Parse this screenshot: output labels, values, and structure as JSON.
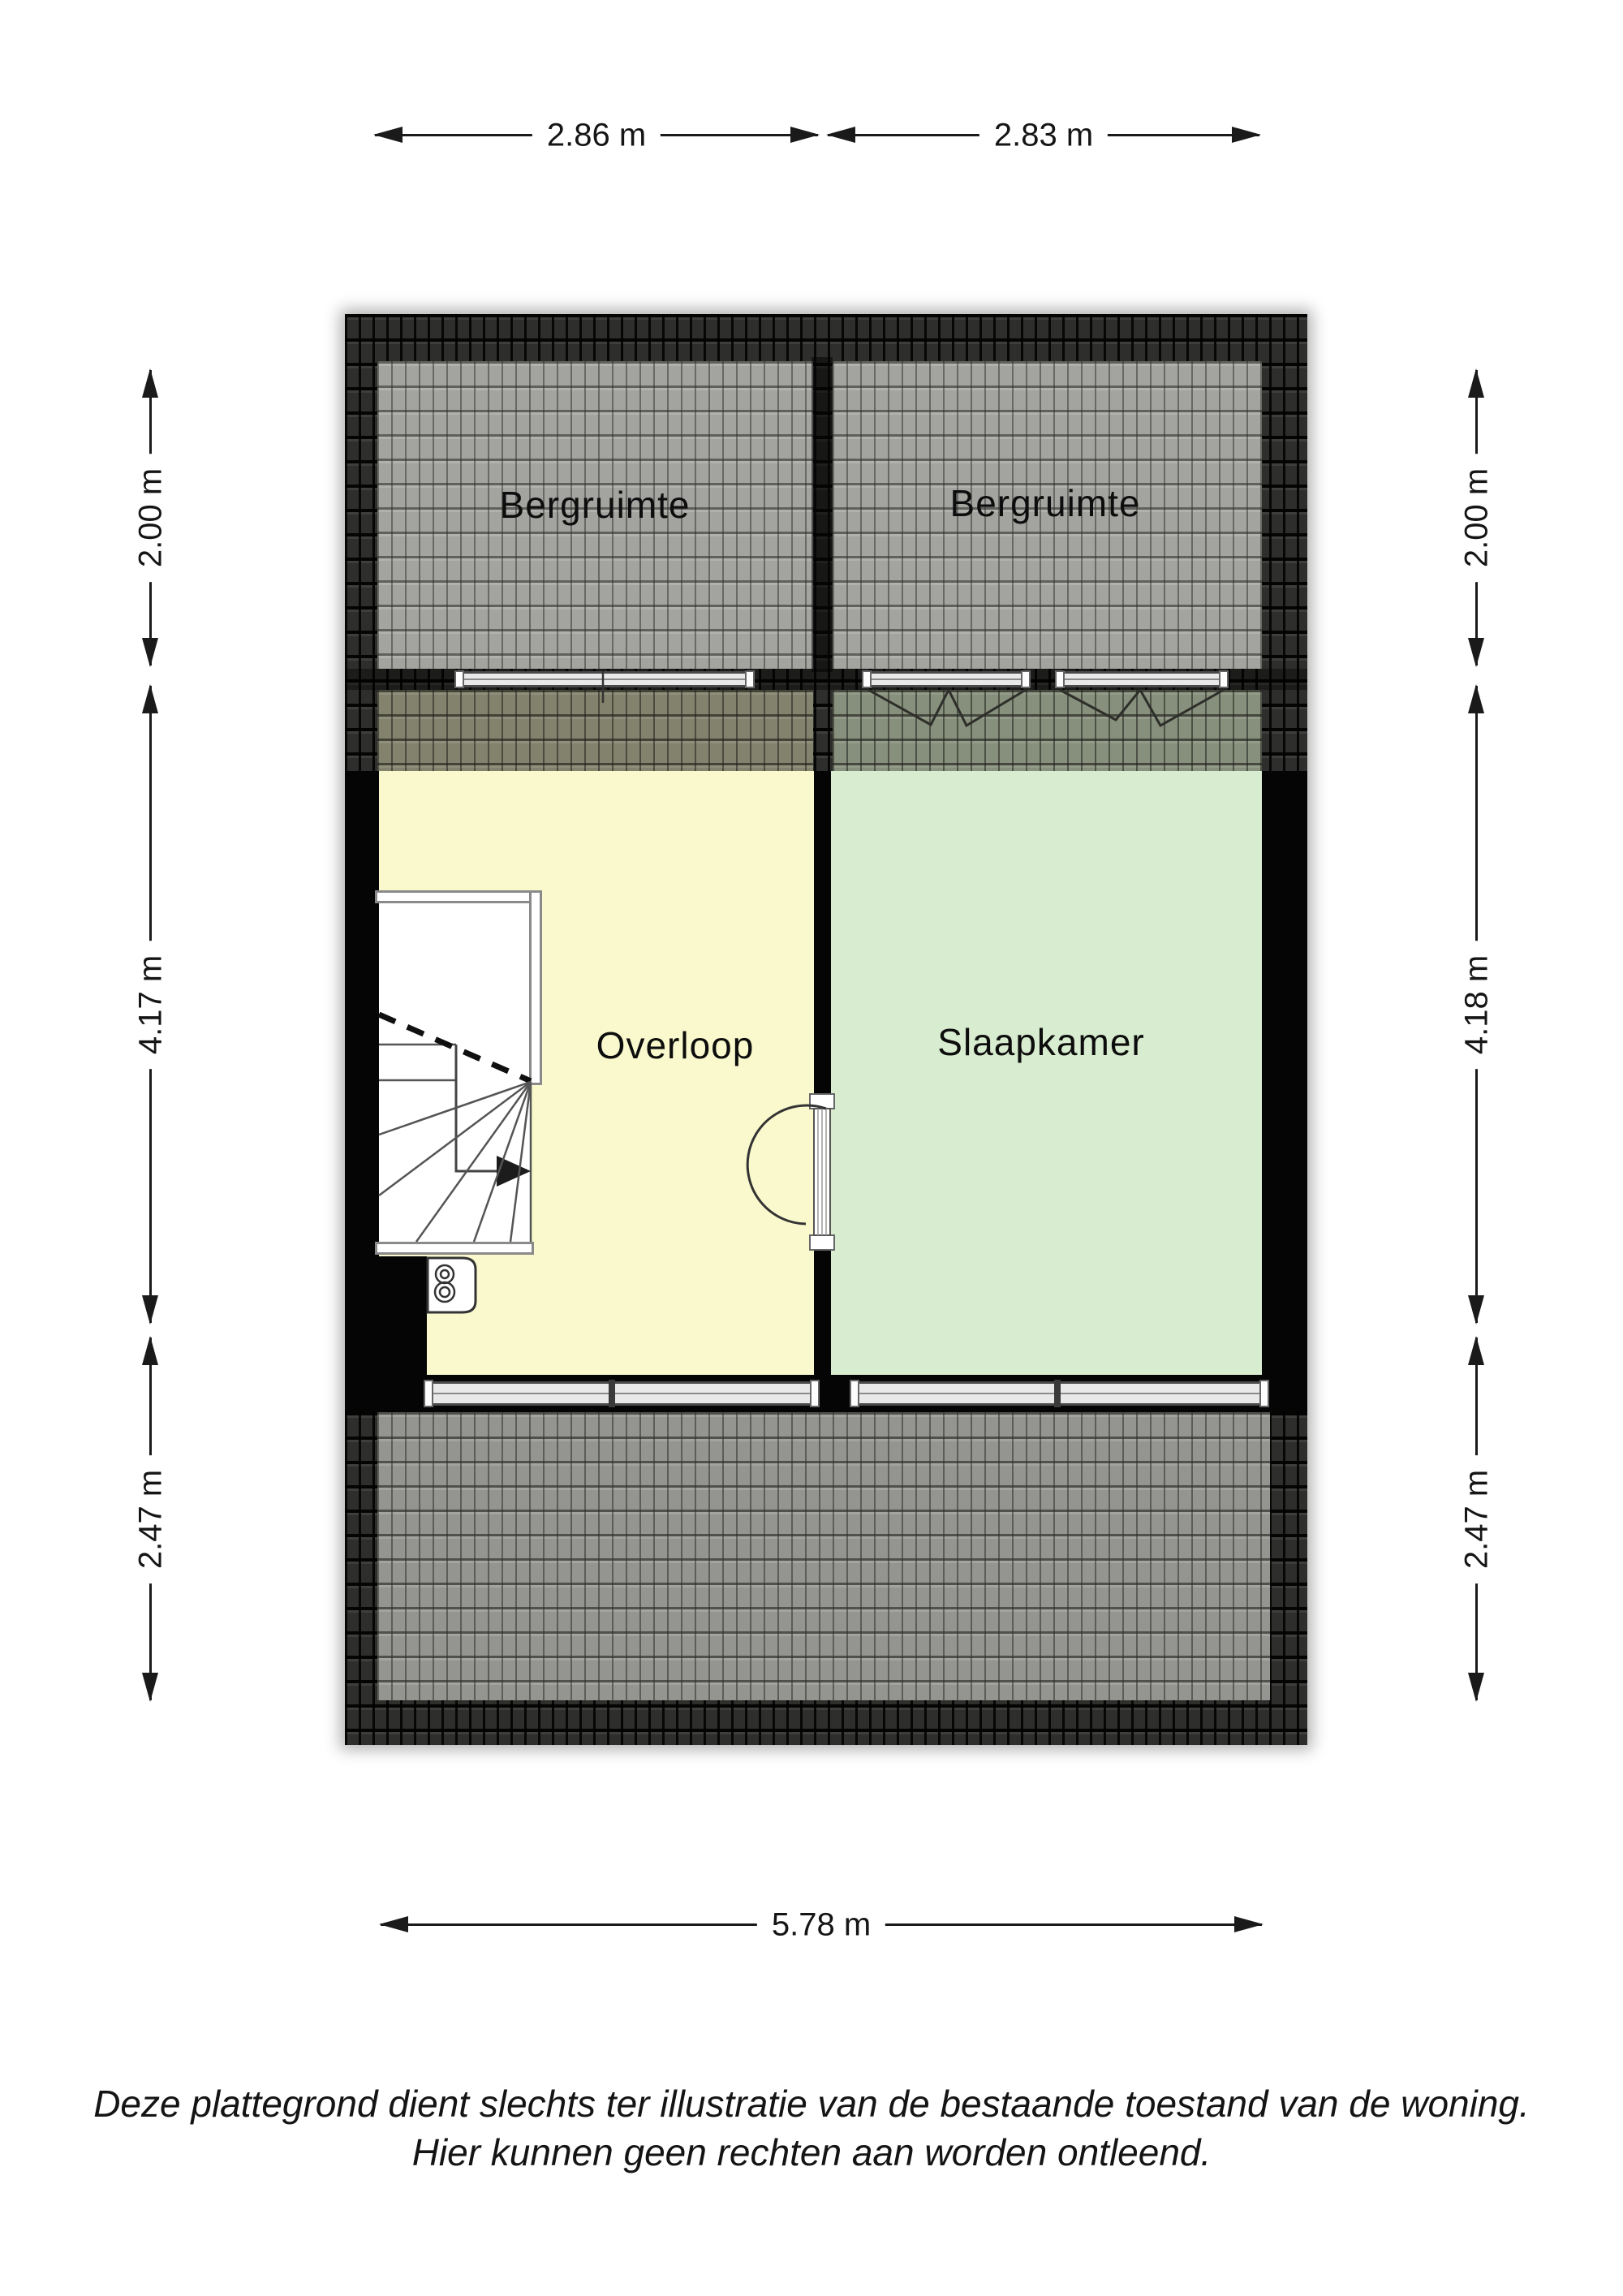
{
  "floorplan": {
    "rooms": {
      "bergruimte_left": "Bergruimte",
      "bergruimte_right": "Bergruimte",
      "overloop": "Overloop",
      "slaapkamer": "Slaapkamer"
    },
    "dimensions": {
      "top_left": "2.86 m",
      "top_right": "2.83 m",
      "left_top": "2.00 m",
      "left_middle": "4.17 m",
      "left_bottom": "2.47 m",
      "right_top": "2.00 m",
      "right_middle": "4.18 m",
      "right_bottom": "2.47 m",
      "bottom": "5.78 m"
    },
    "disclaimer": {
      "line1": "Deze plattegrond dient slechts ter illustratie van de bestaande toestand van de woning.",
      "line2": "Hier kunnen geen rechten aan worden ontleend."
    },
    "colors": {
      "overloop_fill": "#f9f9cd",
      "slaapkamer_fill": "#d8ecd0",
      "roof_dark": "#2e2e2c",
      "roof_light": "#a3a3a0",
      "wall": "#050505",
      "dimension_ink": "#1a1a1a"
    }
  }
}
